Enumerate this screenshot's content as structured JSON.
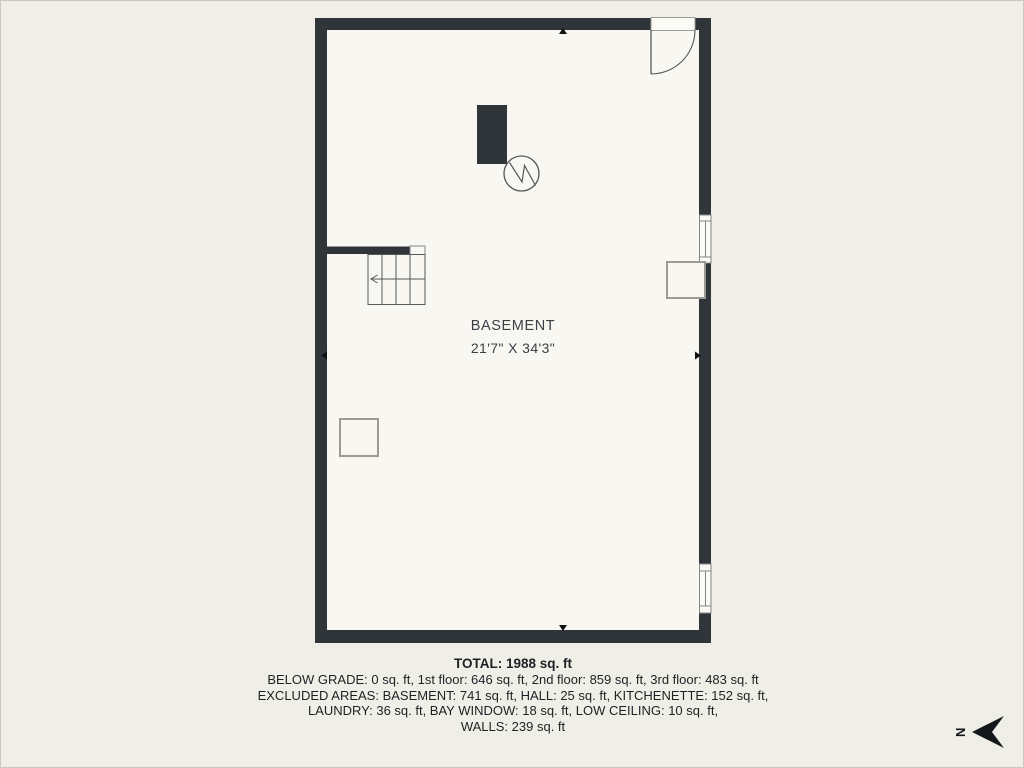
{
  "page": {
    "background_color": "#f0efe7",
    "floor_color": "#f8f7f2",
    "wall_color": "#30353a",
    "outline_color": "#84878a",
    "text_color": "#1d2124"
  },
  "floor_plan": {
    "room_label": "BASEMENT",
    "room_dimensions": "21'7\" X 34'3\"",
    "symbols": [
      "entry-door-icon",
      "window-icon",
      "stairs-icon",
      "chimney-icon",
      "water-heater-icon",
      "electrical-panel-icon",
      "support-post-icon",
      "wall-tick-icon",
      "north-arrow-icon"
    ]
  },
  "compass": {
    "label": "N"
  },
  "summary": {
    "total_line": "TOTAL: 1988 sq. ft",
    "detail_lines": [
      "BELOW GRADE: 0 sq. ft, 1st floor: 646 sq. ft, 2nd floor: 859 sq. ft, 3rd floor: 483 sq. ft",
      "EXCLUDED AREAS: BASEMENT: 741 sq. ft, HALL: 25 sq. ft, KITCHENETTE: 152 sq. ft,",
      "LAUNDRY: 36 sq. ft, BAY WINDOW: 18 sq. ft, LOW CEILING: 10 sq. ft,",
      "WALLS: 239 sq. ft"
    ]
  }
}
